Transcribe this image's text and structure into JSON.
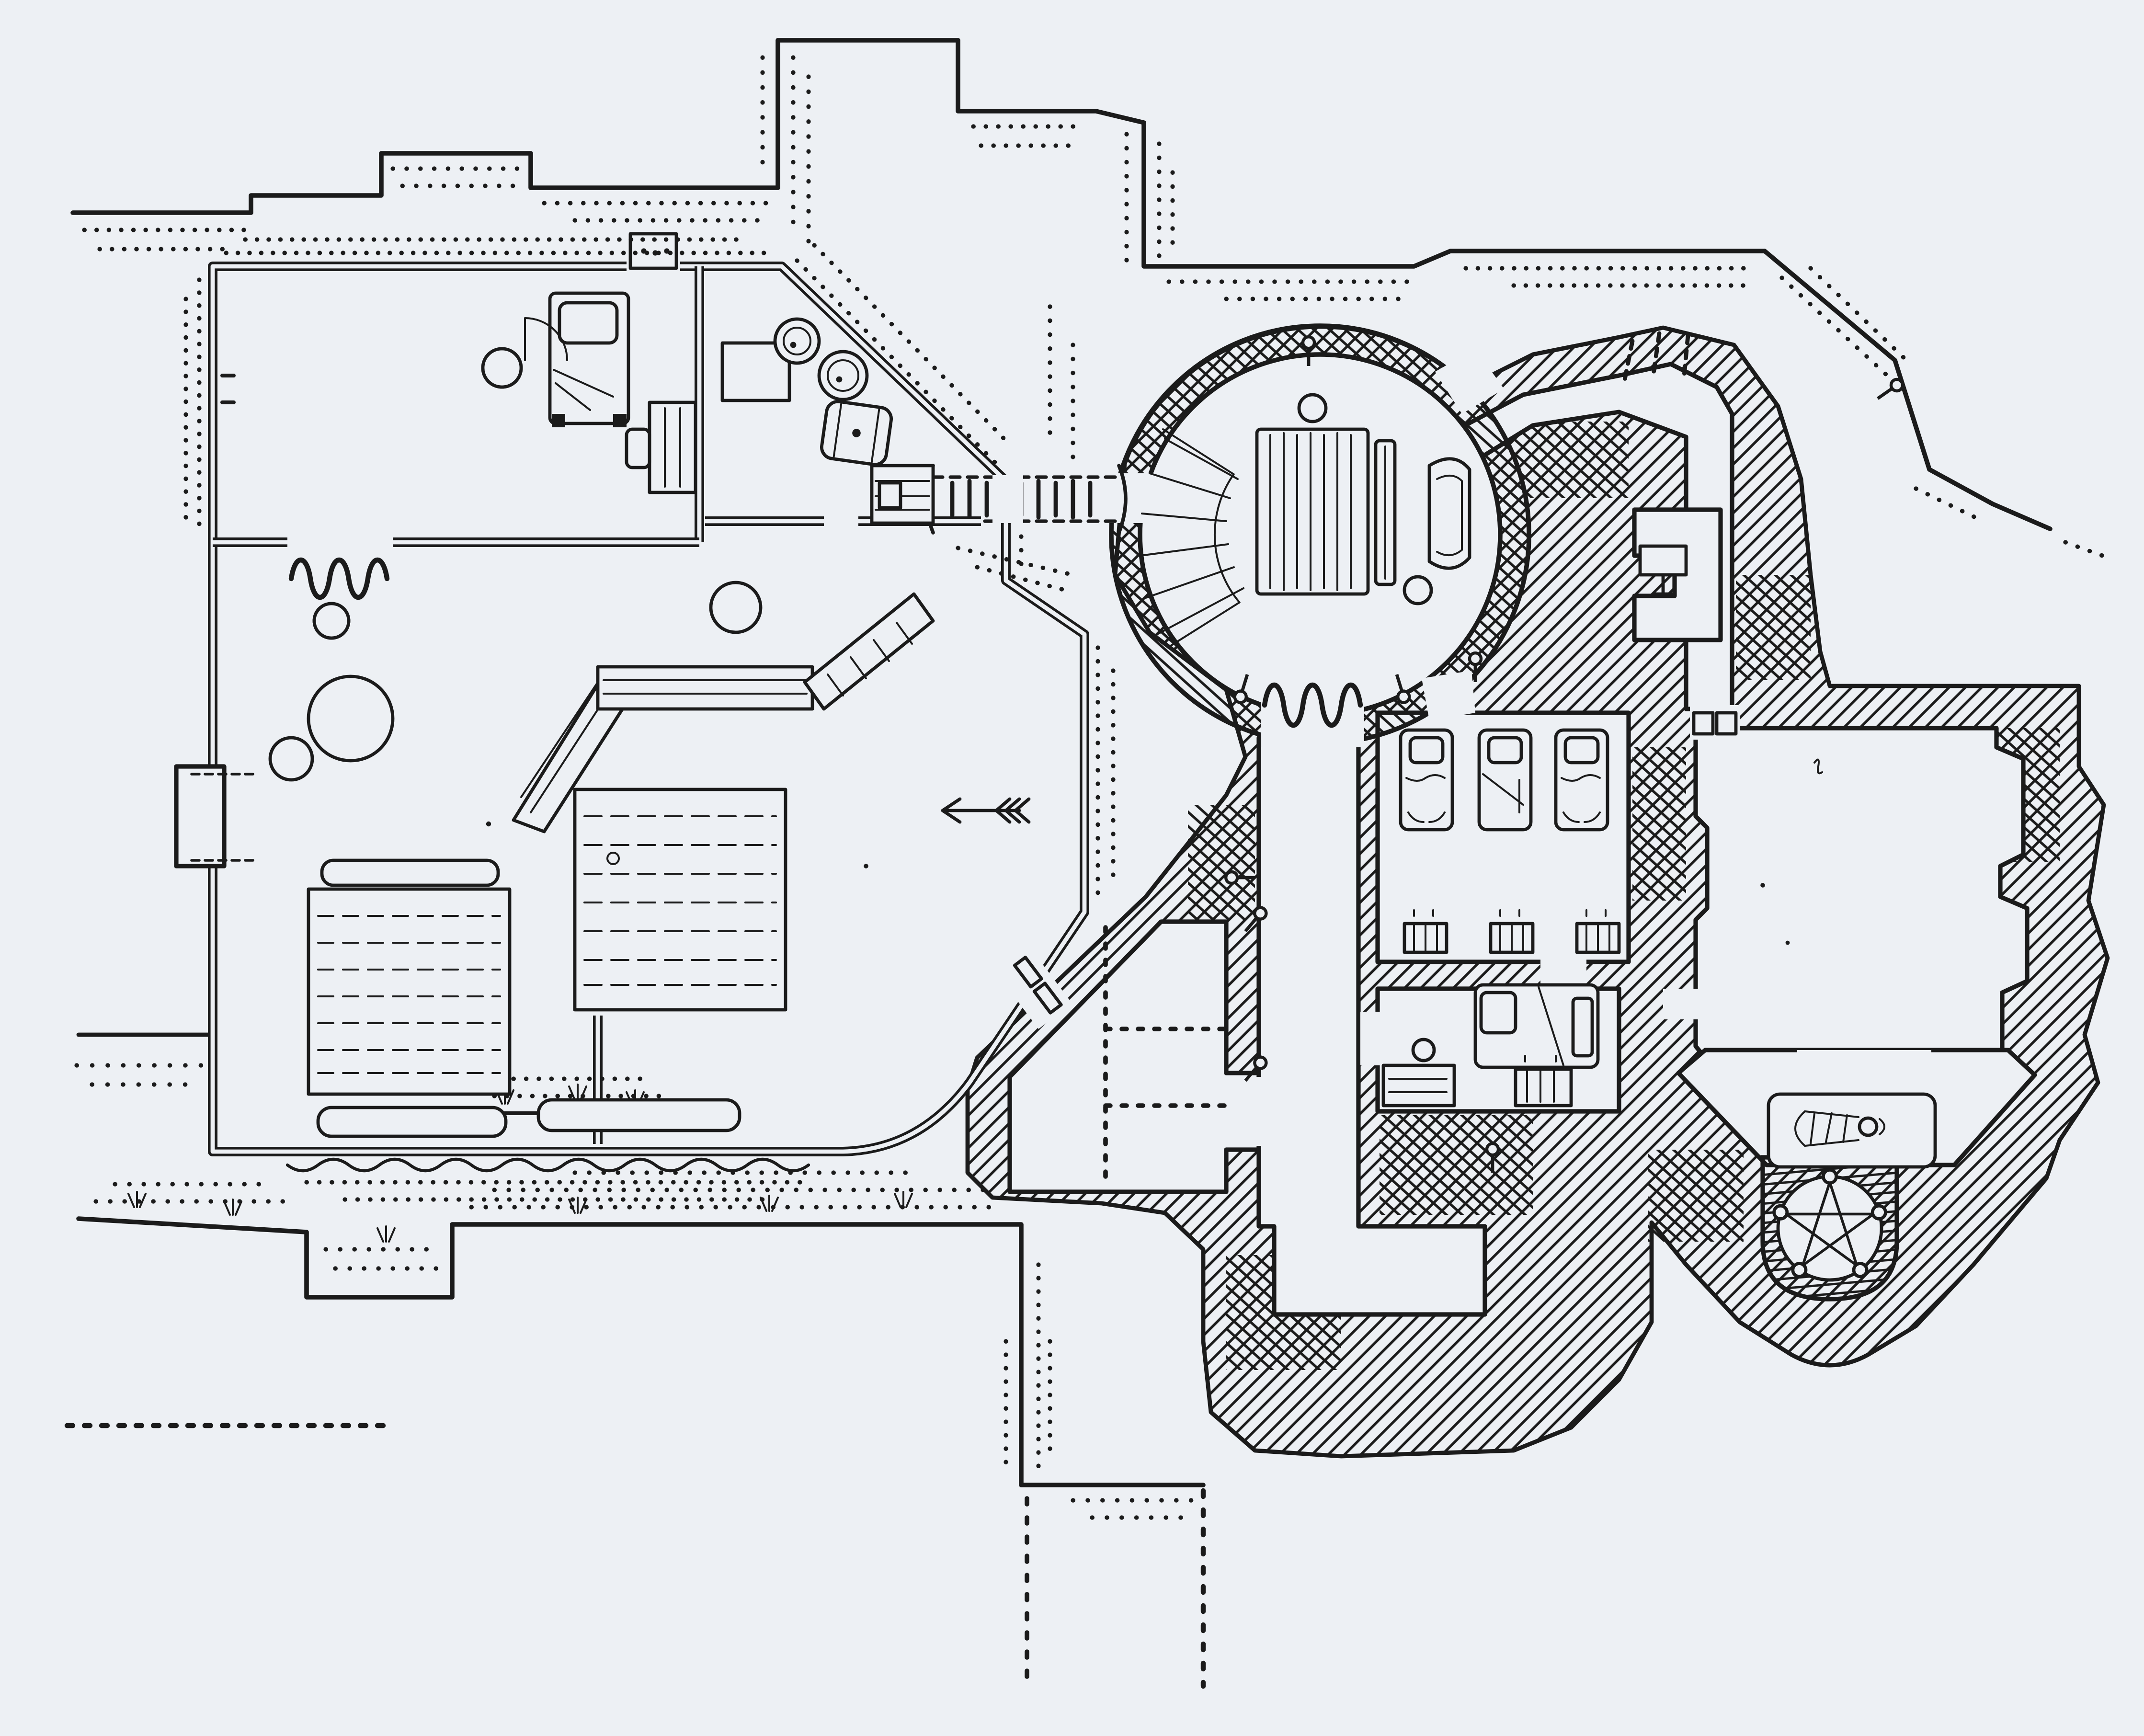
{
  "canvas": {
    "paper_color": "#edf0f4",
    "ink_color": "#1b1b1b",
    "tinted_stone_color": "#d8c0b4",
    "style": "hand-drawn dungeon map, pen and ink"
  },
  "map": {
    "label": "hand-drawn dungeon floor plan",
    "regions": {
      "stone_house": {
        "label": "stone house",
        "rooms": [
          {
            "label": "bedroom",
            "features": [
              "bed",
              "pillow",
              "round-stool",
              "writing-table",
              "chair",
              "door-swing",
              "stone-threshold"
            ]
          },
          {
            "label": "storeroom",
            "features": [
              "shelf-rack",
              "round-barrel",
              "round-barrel",
              "lying-barrel",
              "bridge-crate"
            ]
          },
          {
            "label": "great-hall",
            "features": [
              "corner-counter",
              "boulder",
              "boulder",
              "pebble",
              "pebble",
              "long-table",
              "long-table",
              "bench",
              "bench",
              "bench",
              "roof-post",
              "door-curtain",
              "wall-alcove-doors",
              "arrow-marker"
            ]
          }
        ]
      },
      "rope_bridge": {
        "label": "rope plank bridge over chasm"
      },
      "cave_complex": {
        "label": "cave complex",
        "rooms": [
          {
            "label": "round-hall",
            "features": [
              "curved-stairs",
              "long-plank-table",
              "plank-bench",
              "high-back-chair",
              "round-stool",
              "round-stool",
              "torch-sconce",
              "torch-sconce",
              "torch-sconce",
              "door-curtain"
            ]
          },
          {
            "label": "north-corridor",
            "features": [
              "cave-mouth-dripline",
              "wall-table-alcove",
              "torch-sconce"
            ]
          },
          {
            "label": "dormitory",
            "features": [
              "bed",
              "bed",
              "bed",
              "chest",
              "chest",
              "chest"
            ]
          },
          {
            "label": "private-quarters",
            "features": [
              "bed",
              "desk",
              "round-stool",
              "chest"
            ]
          },
          {
            "label": "west-cavern",
            "features": [
              "survey-dashed-lines",
              "torch-sconce",
              "torch-sconce"
            ]
          },
          {
            "label": "south-dead-end",
            "features": [
              "torch-sconce"
            ]
          },
          {
            "label": "great-cave-hall",
            "features": [
              "buttressed-walls",
              "double-door"
            ]
          },
          {
            "label": "ritual-shrine",
            "features": [
              "altar",
              "lying-figure",
              "pentagram-circle",
              "candle",
              "candle",
              "candle",
              "candle",
              "candle"
            ]
          }
        ]
      }
    },
    "symbols": {
      "rock_wall": "diagonal-hatching",
      "cliff_edge": "stipple-dots",
      "door_curtain": "spring-squiggle",
      "torch_sconce": "pin-with-knob",
      "wood_surface": "plank-lines",
      "grass": "tuft-strokes"
    }
  }
}
